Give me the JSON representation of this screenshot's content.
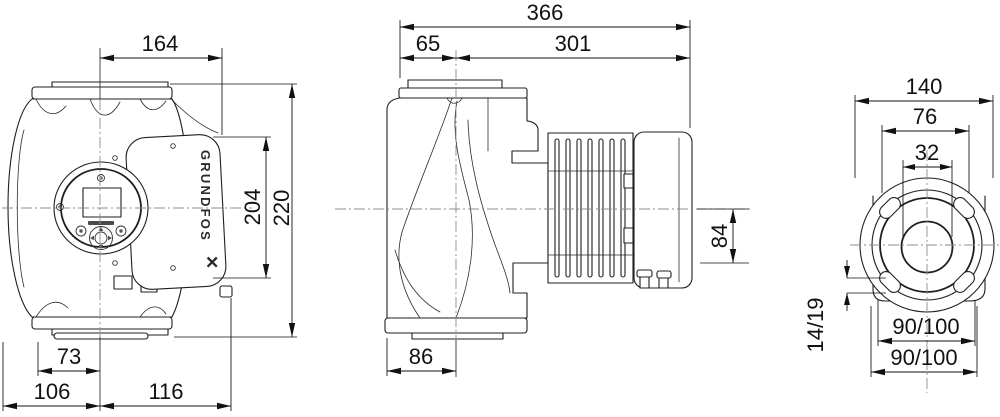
{
  "brand": {
    "name": "GRUNDFOS",
    "mark": "✕"
  },
  "dims": {
    "front": {
      "port_span": "164",
      "box_height": "204",
      "total_height": "220",
      "left_small": "73",
      "bottom_left": "106",
      "bottom_right": "116"
    },
    "side": {
      "total_length": "366",
      "front_depth": "65",
      "rear_depth": "301",
      "below_axis": "84",
      "base_depth": "86"
    },
    "end": {
      "total_width": "140",
      "boss": "76",
      "port": "32",
      "slot": "14/19",
      "bolt_h": "90/100",
      "bolt_v": "90/100"
    }
  }
}
